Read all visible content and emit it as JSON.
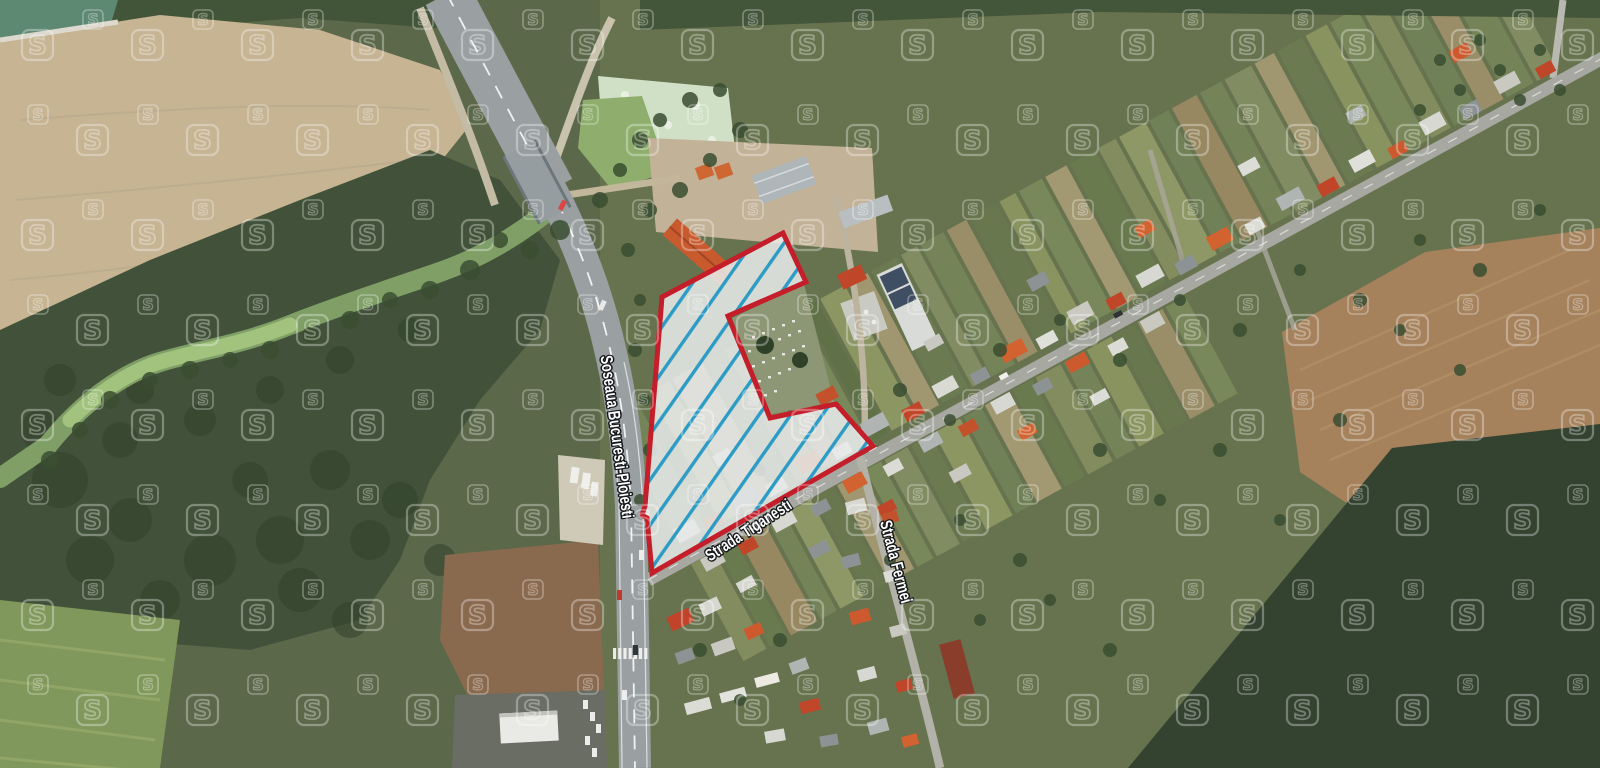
{
  "map": {
    "provider_watermark_letter": "S",
    "watermark_color": "#ffffff",
    "street_labels": [
      {
        "id": "soseaua-bucuresti-ploiesti",
        "text": "Soseaua Bucuresti-Ploiesti"
      },
      {
        "id": "strada-tiganesti",
        "text": "Strada Tiganesti"
      },
      {
        "id": "strada-fermei",
        "text": "Strada Fermei"
      }
    ],
    "parcel": {
      "border_color": "#c41e2a",
      "hatch_color": "#2d9cc5",
      "fill_color": "#e7e9e9"
    }
  }
}
